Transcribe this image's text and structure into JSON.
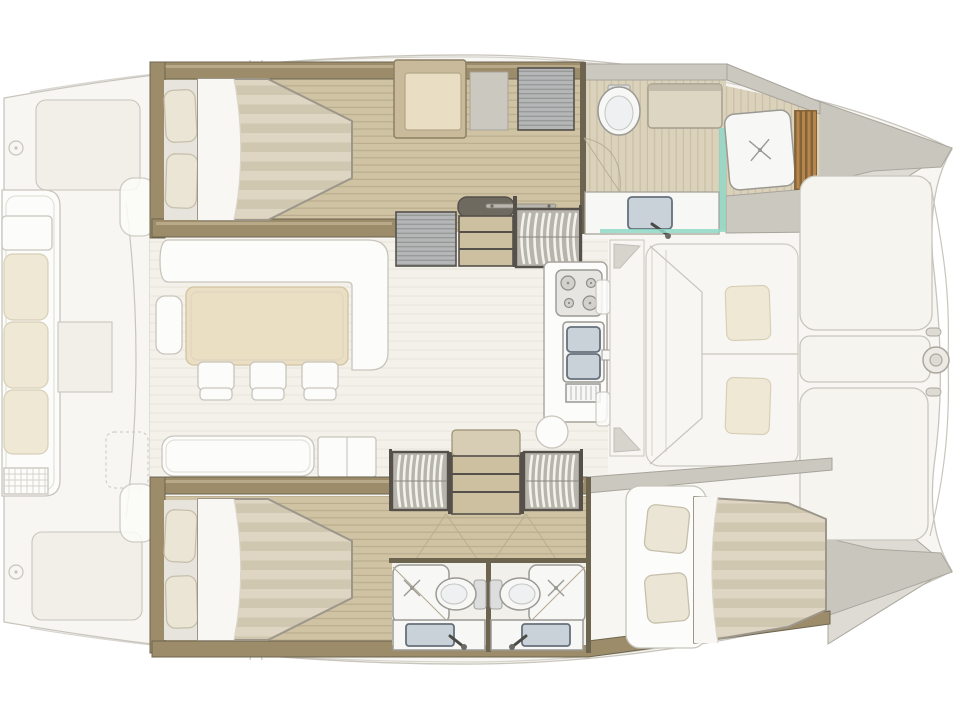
{
  "meta": {
    "title": "Catamaran yacht interior layout floor plan (top view, bows to the right)",
    "type": "boat-floorplan-diagram",
    "canvas": {
      "width": 960,
      "height": 720
    },
    "background": "#ffffff"
  },
  "palette": {
    "paper": "#ffffff",
    "ghost_fill": "#f7f6f2",
    "ghost_fill2": "#f1efe8",
    "ghost_line": "#c8c5bc",
    "white_furn": "#fcfcfa",
    "white_shadow": "#e6e4dc",
    "cushion": "#efe8d4",
    "cushion_line": "#d7cfb8",
    "table_wood": "#eadec3",
    "table_line": "#d2c3a0",
    "saloon_floor": "#f3f1ea",
    "saloon_floor_line": "#e8e5db",
    "wood_floor": "#cfc3a4",
    "wood_floor_line": "#baae8e",
    "wood_light": "#dbd2bc",
    "wood_light_line": "#cabfa4",
    "wall_tan": "#9c8c6a",
    "wall_tan_hi": "#bfb190",
    "wall_dark": "#6d6450",
    "wall_grey": "#cbc8c0",
    "wall_grey_line": "#a7a49b",
    "frame_dark": "#55504a",
    "hatch_bg": "#b4b6b7",
    "hatch_line": "#90938f",
    "drum_bg": "#b7b4ab",
    "drum_rib": "#f3f2ed",
    "step_wood": "#cdc0a1",
    "mattress": "#ded6c3",
    "mattress_stripe": "#d0c7b1",
    "mattress_edge": "#9d968a",
    "sheet": "#f8f7f3",
    "pillow": "#ebe5d5",
    "pillow_line": "#c6bfab",
    "fixture_white": "#f7f7f5",
    "fixture_line": "#9a9993",
    "basin_grey": "#c9d2d9",
    "basin_dark": "#66707a",
    "glass_teal": "#8fd8c6",
    "slat_wood": "#b5874f",
    "slat_dark": "#7c5a2f",
    "door_arc": "#b3a98f",
    "sunpad": "#f5f4ef",
    "bow_deck": "#dedbd4",
    "bow_band": "#c9c6be",
    "bow_line": "#aaa79e",
    "grille_line": "#d4d2c9"
  },
  "legend": {
    "orientation": "bows-right",
    "deck_areas": [
      "aft-cockpit",
      "saloon",
      "galley",
      "forward-cockpit",
      "foredeck-sunpads"
    ],
    "hulls": [
      {
        "name": "port-hull-top",
        "rooms": [
          "owner-cabin",
          "dressing-area",
          "companionway",
          "owner-bathroom"
        ]
      },
      {
        "name": "starboard-hull-bottom",
        "rooms": [
          "guest-cabin-aft",
          "twin-companionways",
          "guest-bathroom-port-side",
          "guest-bathroom-starboard-side",
          "guest-cabin-forward"
        ]
      }
    ],
    "furniture": {
      "double_beds": 3,
      "toilets": 3,
      "showers": 3,
      "sinks": 4,
      "dining_chairs": 3,
      "cockpit_cushions": 3,
      "forward_cushions": 2,
      "stair_drums": 3
    }
  }
}
